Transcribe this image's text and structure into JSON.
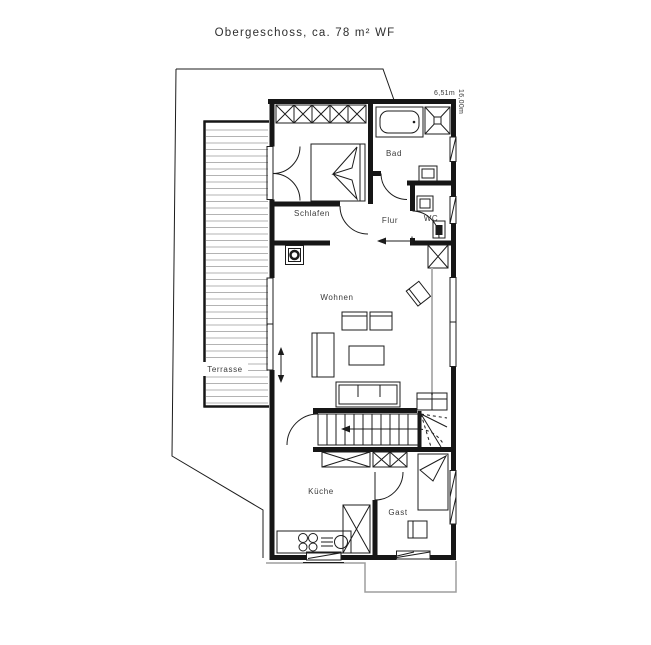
{
  "title": "Obergeschoss, ca. 78 m² WF",
  "dimensions": {
    "width_label": "6,51m",
    "height_label": "16,00m"
  },
  "rooms": [
    {
      "id": "schlafen",
      "label": "Schlafen"
    },
    {
      "id": "bad",
      "label": "Bad"
    },
    {
      "id": "flur",
      "label": "Flur"
    },
    {
      "id": "wc",
      "label": "WC"
    },
    {
      "id": "wohnen",
      "label": "Wohnen"
    },
    {
      "id": "terrasse",
      "label": "Terrasse"
    },
    {
      "id": "kueche",
      "label": "Küche"
    },
    {
      "id": "gast",
      "label": "Gast"
    }
  ],
  "colors": {
    "wall": "#161616",
    "thin_line": "#1c1c1c",
    "decking_gray": "#b3b3b3",
    "lower_floor_outline": "#9e9e9e",
    "background": "#ffffff"
  }
}
